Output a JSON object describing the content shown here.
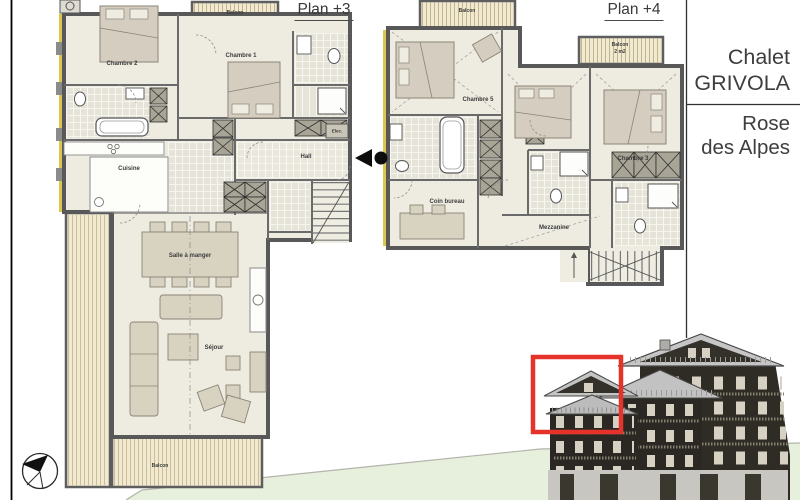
{
  "document": {
    "plan3": {
      "title": "Plan +3",
      "rooms": {
        "balcon_top": "Balcon",
        "chambre2": "Chambre 2",
        "chambre1": "Chambre 1",
        "cuisine": "Cuisine",
        "hall": "Hall",
        "elec": "Elec.",
        "salle_a_manger": "Salle à manger",
        "sejour": "Séjour",
        "balcon_bottom": "Balcon"
      }
    },
    "plan4": {
      "title": "Plan +4",
      "rooms": {
        "balcon_top": "Balcon",
        "balcon_small_line1": "Balcon",
        "balcon_small_line2": "2 m2",
        "chambre5": "Chambre 5",
        "chambre3": "Chambre 3",
        "coin_bureau": "Coin bureau",
        "mezzanine": "Mezzanine"
      }
    },
    "title_block": {
      "line1": "Chalet",
      "line2": "GRIVOLA",
      "line3": "Rose",
      "line4": "des Alpes"
    },
    "icons": {
      "compass": "north-compass-icon",
      "entrance": "entrance-marker-icon"
    },
    "colors": {
      "wall": "#585858",
      "floor": "#eeece1",
      "tile": "#e6e3d8",
      "balcony_wood": "#f1ead0",
      "insulation_yellow": "#dcc74d",
      "terrain_green": "#e6f0dc",
      "highlight_red": "#e5332b",
      "facade_dark": "#2f2c26",
      "roof_grey": "#c6c6c6"
    }
  }
}
